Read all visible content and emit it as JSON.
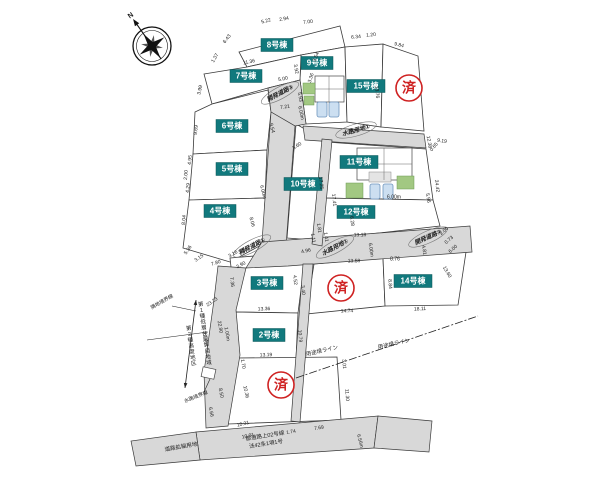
{
  "canvas": {
    "width": 600,
    "height": 477,
    "background": "#ffffff"
  },
  "colors": {
    "stroke": "#3a3a3a",
    "road_fill": "#d8d8d8",
    "parcel_fill": "#ffffff",
    "label_bg": "#11797d",
    "label_fg": "#ffffff",
    "sold_red": "#cf2222",
    "dim_text": "#1a1a1a",
    "green": "#a2c882",
    "green_stroke": "#6d9a55",
    "car_fill": "#ccdff1",
    "car_stroke": "#6f95bd",
    "bld_gray": "#e4e4e4",
    "stamp_text": "#222222"
  },
  "compass": {
    "label": "N",
    "cx": 152,
    "cy": 46,
    "r": 19,
    "rot": -35
  },
  "parcels": [
    {
      "id": "lot-8",
      "label": "8号棟",
      "lx": 277,
      "ly": 45,
      "pts": "239,52 340,26 345,47 301,55 247,67"
    },
    {
      "id": "lot-9",
      "label": "9号棟",
      "lx": 317,
      "ly": 63,
      "pts": "301,55 345,47 347,122 306,124 300,80"
    },
    {
      "id": "lot-7",
      "label": "7号棟",
      "lx": 246,
      "ly": 76,
      "pts": "204,74 247,67 301,55 300,80 268,88 212,104"
    },
    {
      "id": "lot-15",
      "label": "15号棟",
      "lx": 366,
      "ly": 86,
      "pts": "345,47 383,44 381,127 347,122"
    },
    {
      "id": "lot-sold-1",
      "label": null,
      "pts": "383,44 418,56 424,131 381,127"
    },
    {
      "id": "lot-6",
      "label": "6号棟",
      "lx": 232,
      "ly": 126,
      "pts": "195,112 212,104 268,90 271,112 267,150 193,154"
    },
    {
      "id": "lot-5",
      "label": "5号棟",
      "lx": 232,
      "ly": 169,
      "pts": "193,154 267,150 265,198 189,200"
    },
    {
      "id": "lot-4",
      "label": "4号棟",
      "lx": 220,
      "ly": 211,
      "pts": "189,200 265,198 263,244 230,262 183,248"
    },
    {
      "id": "lot-10",
      "label": "10号棟",
      "lx": 303,
      "ly": 184,
      "pts": "296,124 324,140 314,240 287,238"
    },
    {
      "id": "lot-11",
      "label": "11号棟",
      "lx": 359,
      "ly": 162,
      "pts": "326,142 426,149 433,200 322,198"
    },
    {
      "id": "lot-12",
      "label": "12号棟",
      "lx": 356,
      "ly": 212,
      "pts": "322,198 433,200 440,226 317,240"
    },
    {
      "id": "lot-sold-2",
      "label": null,
      "pts": "314,264 383,258 385,306 306,314"
    },
    {
      "id": "lot-14",
      "label": "14号棟",
      "lx": 413,
      "ly": 281,
      "pts": "383,258 466,252 458,305 385,306"
    },
    {
      "id": "lot-3",
      "label": "3号棟",
      "lx": 267,
      "ly": 283,
      "pts": "230,258 302,252 304,266 298,313 236,312"
    },
    {
      "id": "lot-2",
      "label": "2号棟",
      "lx": 269,
      "ly": 335,
      "pts": "236,312 298,313 296,360 238,358"
    },
    {
      "id": "lot-sold-3",
      "label": null,
      "pts": "238,358 337,357 341,420 228,424"
    }
  ],
  "roads": [
    {
      "id": "road-dev-3",
      "pts": "268,88 300,80 306,124 295,126 271,112"
    },
    {
      "id": "road-dev-1-north",
      "pts": "271,112 295,126 286,246 262,242"
    },
    {
      "id": "road-dev-2",
      "pts": "262,242 470,226 472,252 288,266 246,268"
    },
    {
      "id": "road-dev-1-south",
      "pts": "218,266 246,268 236,310 240,355 228,426 206,428 204,372 214,300"
    },
    {
      "id": "road-pref-main",
      "pts": "196,432 378,416 374,448 200,460"
    },
    {
      "id": "road-pref-right",
      "pts": "378,416 432,421 429,452 374,448"
    },
    {
      "id": "road-widening",
      "pts": "196,432 200,460 136,466 131,441"
    }
  ],
  "strips": [
    {
      "id": "strip-water-east-west",
      "pts": "303,126 424,134 426,148 305,140"
    },
    {
      "id": "strip-water-mid",
      "pts": "322,139 332,140 322,246 312,244"
    },
    {
      "id": "strip-water-south",
      "pts": "303,264 313,264 300,422 291,421"
    }
  ],
  "road_stamps": [
    {
      "t": "開発道路①",
      "x": 252,
      "y": 246,
      "r": -28
    },
    {
      "t": "水路用地①",
      "x": 335,
      "y": 247,
      "r": -28
    },
    {
      "t": "開発道路②",
      "x": 428,
      "y": 237,
      "r": -24
    },
    {
      "t": "開発道路③",
      "x": 280,
      "y": 93,
      "r": -28
    },
    {
      "t": "水路用地①",
      "x": 356,
      "y": 130,
      "r": -16
    }
  ],
  "sold_marks": {
    "char": "済",
    "positions": [
      {
        "x": 409,
        "y": 88
      },
      {
        "x": 341,
        "y": 288
      },
      {
        "x": 281,
        "y": 385
      }
    ]
  },
  "buildings": {
    "shapes": [
      {
        "kind": "rect",
        "x": 315,
        "y": 76,
        "w": 29,
        "h": 26,
        "f": "bld"
      },
      {
        "kind": "rect",
        "x": 303,
        "y": 83,
        "w": 12,
        "h": 11,
        "f": "green"
      },
      {
        "kind": "rect",
        "x": 304,
        "y": 96,
        "w": 10,
        "h": 9,
        "f": "green"
      },
      {
        "kind": "rect",
        "x": 317,
        "y": 102,
        "w": 10,
        "h": 15,
        "f": "car",
        "rx": 2
      },
      {
        "kind": "rect",
        "x": 329,
        "y": 102,
        "w": 10,
        "h": 15,
        "f": "car",
        "rx": 2
      },
      {
        "kind": "rect",
        "x": 357,
        "y": 148,
        "w": 55,
        "h": 32,
        "f": "bld"
      },
      {
        "kind": "rect",
        "x": 369,
        "y": 172,
        "w": 22,
        "h": 10,
        "f": "gray"
      },
      {
        "kind": "rect",
        "x": 346,
        "y": 183,
        "w": 17,
        "h": 15,
        "f": "green"
      },
      {
        "kind": "rect",
        "x": 397,
        "y": 176,
        "w": 17,
        "h": 13,
        "f": "green"
      },
      {
        "kind": "rect",
        "x": 370,
        "y": 184,
        "w": 10,
        "h": 15,
        "f": "car",
        "rx": 2
      },
      {
        "kind": "rect",
        "x": 383,
        "y": 184,
        "w": 10,
        "h": 15,
        "f": "car",
        "rx": 2
      },
      {
        "kind": "rect",
        "x": 202,
        "y": 368,
        "w": 13,
        "h": 10,
        "f": "bld",
        "rot": 12
      }
    ],
    "lines": [
      {
        "x1": 315,
        "y1": 89,
        "x2": 344,
        "y2": 89
      },
      {
        "x1": 329,
        "y1": 76,
        "x2": 329,
        "y2": 102
      },
      {
        "x1": 357,
        "y1": 164,
        "x2": 412,
        "y2": 164
      },
      {
        "x1": 384,
        "y1": 148,
        "x2": 384,
        "y2": 180
      }
    ]
  },
  "lines": [
    {
      "id": "use-district-line",
      "pts": "296,378 478,316",
      "dash": "8 2 2 2",
      "w": 0.8
    },
    {
      "id": "water-boundary-leader",
      "pts": "204,392 210,379",
      "dash": "",
      "w": 0.6
    },
    {
      "id": "adjacent-boundary-leader",
      "pts": "172,306 196,311",
      "dash": "",
      "w": 0.6
    }
  ],
  "zoning": {
    "arrow": {
      "x1": 196,
      "y1": 300,
      "x2": 185,
      "y2": 388
    },
    "tick": {
      "pts": "147,340 208,332"
    },
    "texts": [
      {
        "t": "第1種低層住居専用地域",
        "x": 201,
        "y": 306,
        "r": -8,
        "size": 5.5
      },
      {
        "t": "第2種高度地区",
        "x": 189,
        "y": 330,
        "r": -8,
        "size": 5.5
      }
    ]
  },
  "misc_labels": [
    {
      "t": "隣地境界線",
      "x": 162,
      "y": 302,
      "r": -30,
      "size": 5
    },
    {
      "t": "水路境界線",
      "x": 196,
      "y": 397,
      "r": -22,
      "size": 5
    },
    {
      "t": "用途境ライン",
      "x": 322,
      "y": 351,
      "r": -13,
      "size": 5.5
    },
    {
      "t": "用途境ライン",
      "x": 394,
      "y": 344,
      "r": -13,
      "size": 5.5
    },
    {
      "t": "道路拡幅用地",
      "x": 181,
      "y": 447,
      "r": -10,
      "size": 5.5
    },
    {
      "t": "都道路上02号線",
      "x": 265,
      "y": 436,
      "r": -9,
      "size": 5.5
    },
    {
      "t": "法42条1項1号",
      "x": 266,
      "y": 444,
      "r": -9,
      "size": 5.5
    }
  ],
  "dimensions": [
    {
      "t": "5.22",
      "x": 266,
      "y": 21,
      "r": -14
    },
    {
      "t": "2.94",
      "x": 284,
      "y": 19,
      "r": -10
    },
    {
      "t": "7.00",
      "x": 308,
      "y": 22,
      "r": -6
    },
    {
      "t": "6.43",
      "x": 227,
      "y": 39,
      "r": -52
    },
    {
      "t": "1.37",
      "x": 215,
      "y": 58,
      "r": -60
    },
    {
      "t": "11.36",
      "x": 249,
      "y": 62,
      "r": -12
    },
    {
      "t": "3.99",
      "x": 200,
      "y": 90,
      "r": -78
    },
    {
      "t": "5.00",
      "x": 283,
      "y": 79,
      "r": -12
    },
    {
      "t": "7.21",
      "x": 285,
      "y": 107,
      "r": -8
    },
    {
      "t": "3.92",
      "x": 296,
      "y": 69,
      "r": 78
    },
    {
      "t": "5.93",
      "x": 300,
      "y": 97,
      "r": 80
    },
    {
      "t": "6.00m",
      "x": 301,
      "y": 113,
      "r": 78
    },
    {
      "t": "9.17",
      "x": 354,
      "y": 131,
      "r": 8
    },
    {
      "t": "9.19",
      "x": 442,
      "y": 141,
      "r": 8
    },
    {
      "t": "6.34",
      "x": 356,
      "y": 37,
      "r": -5
    },
    {
      "t": "1.20",
      "x": 371,
      "y": 35,
      "r": -5
    },
    {
      "t": "9.84",
      "x": 399,
      "y": 45,
      "r": 14
    },
    {
      "t": "13.76",
      "x": 377,
      "y": 92,
      "r": 85
    },
    {
      "t": "8.76",
      "x": 401,
      "y": 90,
      "r": 84
    },
    {
      "t": "3.54",
      "x": 316,
      "y": 57,
      "r": -68
    },
    {
      "t": "3.36",
      "x": 311,
      "y": 78,
      "r": -72
    },
    {
      "t": "0.65",
      "x": 434,
      "y": 147,
      "r": -50
    },
    {
      "t": "9.69",
      "x": 196,
      "y": 130,
      "r": -84
    },
    {
      "t": "9.54",
      "x": 272,
      "y": 128,
      "r": 76
    },
    {
      "t": "4.95",
      "x": 190,
      "y": 160,
      "r": -84
    },
    {
      "t": "2.00",
      "x": 186,
      "y": 175,
      "r": -84
    },
    {
      "t": "4.29",
      "x": 188,
      "y": 188,
      "r": -84
    },
    {
      "t": "6.00m",
      "x": 263,
      "y": 192,
      "r": 76
    },
    {
      "t": "8.04",
      "x": 184,
      "y": 220,
      "r": -84
    },
    {
      "t": "8.06",
      "x": 252,
      "y": 222,
      "r": 76
    },
    {
      "t": "5.36",
      "x": 188,
      "y": 250,
      "r": -55
    },
    {
      "t": "3.15",
      "x": 199,
      "y": 258,
      "r": -35
    },
    {
      "t": "7.80",
      "x": 216,
      "y": 263,
      "r": -18
    },
    {
      "t": "3.90",
      "x": 241,
      "y": 265,
      "r": -28
    },
    {
      "t": "3.60",
      "x": 297,
      "y": 146,
      "r": -32
    },
    {
      "t": "17.25",
      "x": 321,
      "y": 183,
      "r": 84
    },
    {
      "t": "17.41",
      "x": 334,
      "y": 200,
      "r": 84
    },
    {
      "t": "1.81",
      "x": 319,
      "y": 228,
      "r": 80
    },
    {
      "t": "1.11",
      "x": 313,
      "y": 238,
      "r": 80
    },
    {
      "t": "1.41",
      "x": 326,
      "y": 237,
      "r": 80
    },
    {
      "t": "4.96",
      "x": 306,
      "y": 251,
      "r": -12
    },
    {
      "t": "12.38",
      "x": 429,
      "y": 142,
      "r": 80
    },
    {
      "t": "24.42",
      "x": 437,
      "y": 186,
      "r": 82
    },
    {
      "t": "5.96",
      "x": 428,
      "y": 198,
      "r": 80
    },
    {
      "t": "2.00",
      "x": 444,
      "y": 231,
      "r": -42
    },
    {
      "t": "0.73",
      "x": 449,
      "y": 240,
      "r": -42
    },
    {
      "t": "6.00",
      "x": 453,
      "y": 249,
      "r": -42
    },
    {
      "t": "6.00m",
      "x": 394,
      "y": 197,
      "r": 0
    },
    {
      "t": "13.18",
      "x": 360,
      "y": 235,
      "r": -1
    },
    {
      "t": "6.28",
      "x": 352,
      "y": 221,
      "r": 84
    },
    {
      "t": "6.00m",
      "x": 371,
      "y": 250,
      "r": 82
    },
    {
      "t": "8.76",
      "x": 395,
      "y": 259,
      "r": 0
    },
    {
      "t": "4.81",
      "x": 424,
      "y": 250,
      "r": 80
    },
    {
      "t": "13.60",
      "x": 447,
      "y": 272,
      "r": 60
    },
    {
      "t": "18.11",
      "x": 420,
      "y": 309,
      "r": -3
    },
    {
      "t": "8.84",
      "x": 390,
      "y": 284,
      "r": 86
    },
    {
      "t": "13.58",
      "x": 354,
      "y": 261,
      "r": -1
    },
    {
      "t": "14.74",
      "x": 347,
      "y": 311,
      "r": -2
    },
    {
      "t": "3.16",
      "x": 233,
      "y": 254,
      "r": -30
    },
    {
      "t": "3.10",
      "x": 243,
      "y": 251,
      "r": -20
    },
    {
      "t": "7.36",
      "x": 232,
      "y": 282,
      "r": 84
    },
    {
      "t": "13.36",
      "x": 264,
      "y": 309,
      "r": -2
    },
    {
      "t": "4.52",
      "x": 295,
      "y": 280,
      "r": 84
    },
    {
      "t": "3.40",
      "x": 303,
      "y": 290,
      "r": 84
    },
    {
      "t": "10.79",
      "x": 300,
      "y": 336,
      "r": 86
    },
    {
      "t": "13.19",
      "x": 266,
      "y": 355,
      "r": -2
    },
    {
      "t": "1.00m",
      "x": 227,
      "y": 334,
      "r": 80
    },
    {
      "t": "23.23",
      "x": 212,
      "y": 302,
      "r": -35
    },
    {
      "t": "22.90",
      "x": 220,
      "y": 327,
      "r": 80
    },
    {
      "t": "29.45",
      "x": 205,
      "y": 338,
      "r": 80
    },
    {
      "t": "1.70",
      "x": 243,
      "y": 364,
      "r": 80
    },
    {
      "t": "10.36",
      "x": 246,
      "y": 392,
      "r": 78
    },
    {
      "t": "3.01",
      "x": 344,
      "y": 364,
      "r": 86
    },
    {
      "t": "11.30",
      "x": 347,
      "y": 395,
      "r": 86
    },
    {
      "t": "8.50",
      "x": 221,
      "y": 393,
      "r": 78
    },
    {
      "t": "6.66",
      "x": 211,
      "y": 412,
      "r": 78
    },
    {
      "t": "10.31",
      "x": 243,
      "y": 424,
      "r": -14
    },
    {
      "t": "10.01",
      "x": 248,
      "y": 436,
      "r": -12
    },
    {
      "t": "1.74",
      "x": 291,
      "y": 432,
      "r": -10
    },
    {
      "t": "7.69",
      "x": 319,
      "y": 428,
      "r": -10
    },
    {
      "t": "6.56m",
      "x": 360,
      "y": 441,
      "r": 76
    }
  ]
}
